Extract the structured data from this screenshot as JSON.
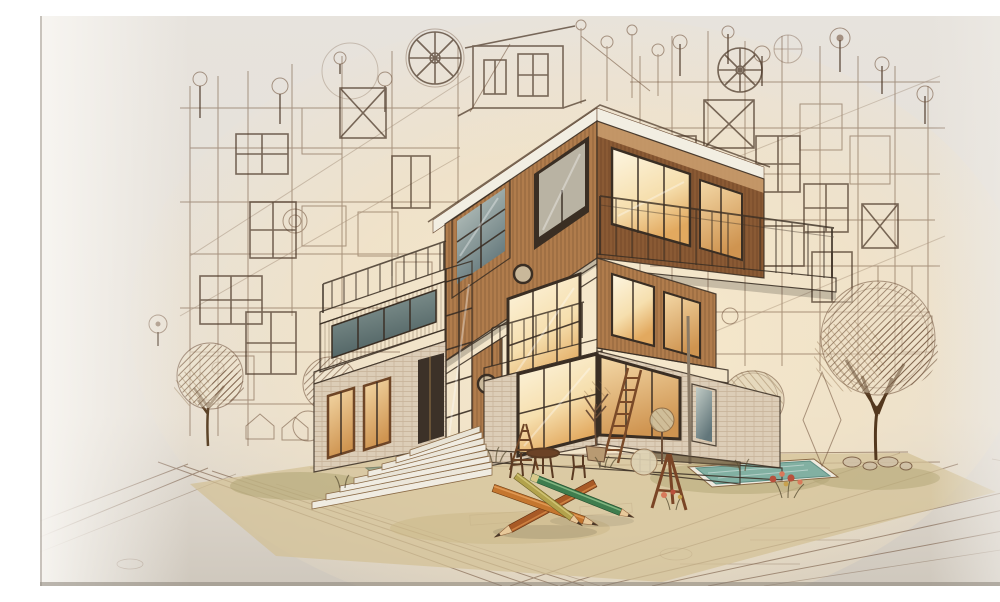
{
  "image": {
    "title": "Architectural concept sketch",
    "alt": "Sepia architectural sketch of a modern three-story house with wood cladding, glowing amber windows, teal glass, white balcony slabs and railings, surrounded by blueprint facade drawings, hand-drawn trees, stairs, ladders, an easel, a small pool, cafe table and chairs, and large crossed colored pencils in the foreground."
  },
  "palette": {
    "bg": "#e9e4dd",
    "bg-shade": "#d5cec4",
    "glow": "#f6e8cb",
    "line": "#6e4f38",
    "line-dark": "#473323",
    "wood-light": "#c99c6d",
    "wood-mid": "#b07c4c",
    "wood-dark": "#8a5a34",
    "wood-deep": "#6e4526",
    "trim": "#f2eee2",
    "frame": "#3a2e23",
    "teal-light": "#b7c3bd",
    "teal-dark": "#64787a",
    "amber-light": "#fbf0d8",
    "amber-mid": "#edc078",
    "amber-deep": "#cf9450",
    "brick": "#dccdb7",
    "brick-line": "#9a7a58",
    "courtyard": "#d3c096",
    "grass": "#b1a676",
    "pool": "#82b0a2",
    "pond": "#93a489",
    "pencil-green": "#3f7d4e",
    "pencil-orange": "#c4762f",
    "pencil-rust": "#a85a26",
    "pencil-olive": "#b2a24c",
    "pencil-wood": "#e8c99a",
    "pencil-lead": "#4a3828",
    "furniture": "#5a3a22",
    "easel": "#7a4526",
    "flower-red": "#b8503c",
    "flower-pink": "#d8795a"
  },
  "scene": {
    "style": "sepia pencil blueprint sketch blended with warm rendered building",
    "blueprint": {
      "left_cluster": "facade line drawings with window grids, X-braced panels, dimension markers and a compass wheel",
      "right_cluster": "facade line drawings with circles, survey markers and compass wheels",
      "rooftop": "sketched penthouse tower with antenna lines and circle markers"
    },
    "building": {
      "floors": 3,
      "top_floor": "wood-slat box, dark-framed window, teal corner window, open balcony with thin railing and amber glass doors",
      "middle_floor": "left balcony with railing, teal curtain-wall strip, porthole detail, bright amber corner window with balcony",
      "ground_floor": "brick-textured walls, large glowing corner window, entrance door, narrow windows, white plinth"
    },
    "site": {
      "stairs": "wide white steps descending to the lower left terrace",
      "pools": [
        "small teal pool at right",
        "green pond left of the stairs"
      ],
      "vegetation": [
        "two hatched sketch trees at left",
        "round shrub",
        "large cross-hatched tree at right",
        "diamond-shaped bush",
        "scribbled round tree near the house",
        "potted sapling",
        "red flower clusters"
      ],
      "props": [
        "leaning ladder",
        "step ladder",
        "round cafe table with two chairs",
        "wooden A-frame easel",
        "planter boxes"
      ]
    },
    "foreground": {
      "pencils": [
        {
          "color_name": "rust orange",
          "pointing": "lower-left"
        },
        {
          "color_name": "orange",
          "pointing": "lower-right"
        },
        {
          "color_name": "olive",
          "pointing": "lower-right"
        },
        {
          "color_name": "green",
          "pointing": "right"
        }
      ]
    }
  }
}
